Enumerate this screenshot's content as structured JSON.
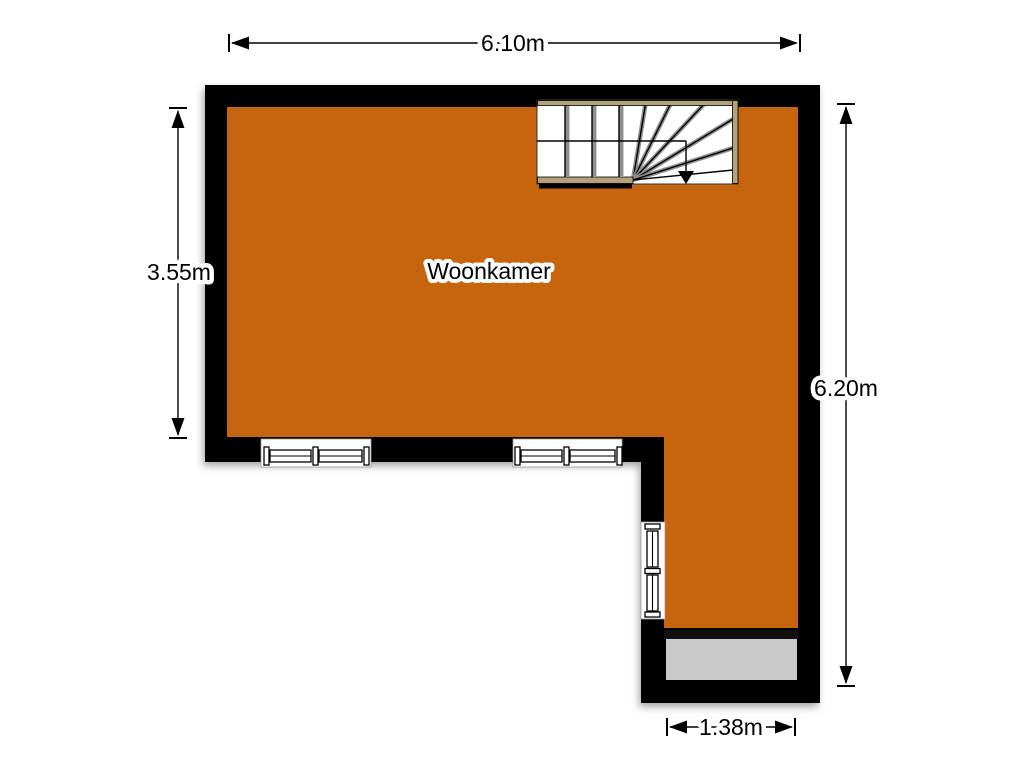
{
  "plan": {
    "room": {
      "label": "Woonkamer"
    },
    "dimensions": {
      "top": "6.10m",
      "left": "3.55m",
      "right": "6.20m",
      "bottom": "1.38m"
    },
    "colors": {
      "floor": "#c6650e",
      "wall": "#000000",
      "porch": "#c9c9c9",
      "stair_trim": "#b2a27a",
      "background": "#ffffff"
    }
  }
}
